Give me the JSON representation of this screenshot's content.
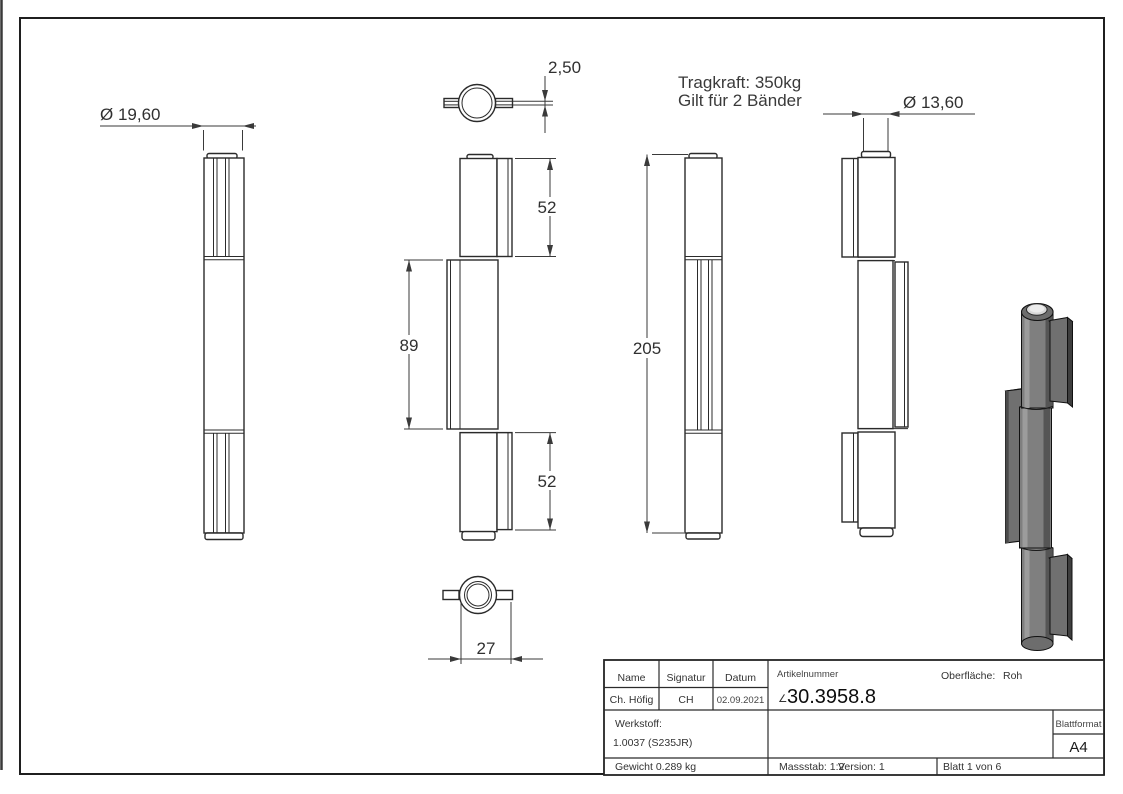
{
  "annotations": {
    "tragkraft_line1": "Tragkraft: 350kg",
    "tragkraft_line2": "Gilt für 2 Bänder"
  },
  "dims": {
    "dia_knuckle": "Ø 19,60",
    "tab_thickness": "2,50",
    "knuckle_top_height": "52",
    "leaf_height": "89",
    "knuckle_bottom_height": "52",
    "total_height": "205",
    "dia_pin": "Ø 13,60",
    "leaf_width": "27"
  },
  "title_block": {
    "name_label": "Name",
    "signatur_label": "Signatur",
    "datum_label": "Datum",
    "name_value": "Ch. Höfig",
    "signatur_value": "CH",
    "datum_value": "02.09.2021",
    "artikelnummer_label": "Artikelnummer",
    "artikelnummer_prefix": "∠",
    "artikelnummer_value": "30.3958.8",
    "oberflaeche_label": "Oberfläche:",
    "oberflaeche_value": "Roh",
    "werkstoff_label": "Werkstoff:",
    "werkstoff_value": "1.0037 (S235JR)",
    "blattformat_label": "Blattformat",
    "blattformat_value": "A4",
    "gewicht": "Gewicht 0.289 kg",
    "massstab": "Massstab: 1:2",
    "version": "Version: 1",
    "blatt": "Blatt 1 von 6"
  },
  "colors": {
    "line": "#2b2b2b",
    "dimension": "#3a3a3a",
    "metal_mid": "#7f7f7f",
    "metal_dark": "#555555",
    "metal_light": "#9c9c9c",
    "pin_top": "#d8d8d8"
  }
}
